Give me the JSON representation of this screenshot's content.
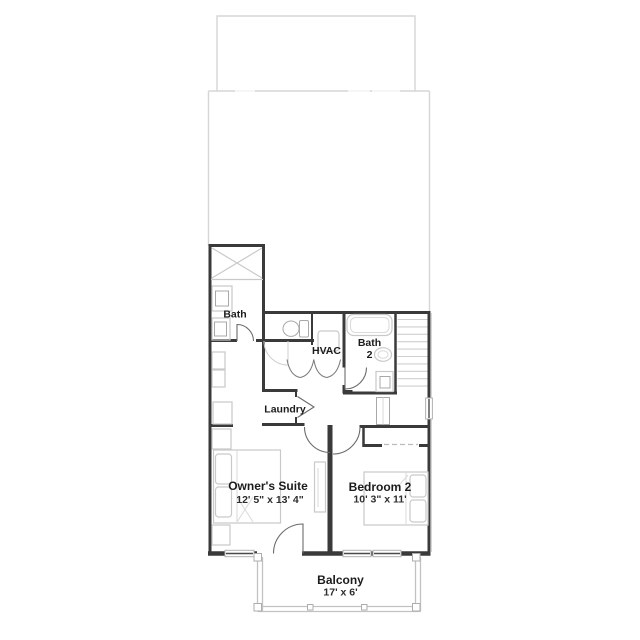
{
  "colors": {
    "wall": "#3a3a3a",
    "fixture": "#c9c9c9",
    "faint_outline": "#d6d6d6",
    "door": "#6b6b6b",
    "text": "#1c1c1c",
    "background": "#ffffff"
  },
  "rooms": {
    "bath": {
      "label": "Bath"
    },
    "hvac": {
      "label": "HVAC"
    },
    "bath2": {
      "label_line1": "Bath",
      "label_line2": "2"
    },
    "laundry": {
      "label": "Laundry"
    },
    "owners_suite": {
      "label": "Owner's Suite",
      "dimensions": "12' 5\" x 13' 4\""
    },
    "bedroom2": {
      "label": "Bedroom 2",
      "dimensions": "10' 3\" x 11'"
    },
    "balcony": {
      "label": "Balcony",
      "dimensions": "17' x 6'"
    }
  }
}
